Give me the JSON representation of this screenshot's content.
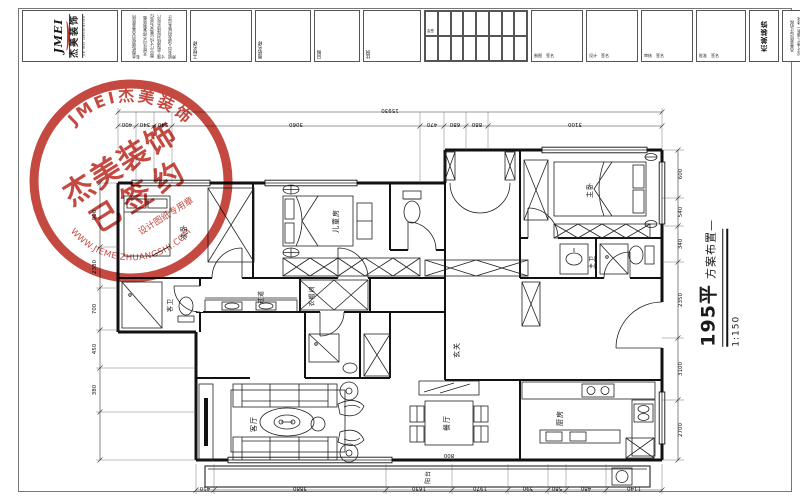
{
  "sheet": {
    "area_label": "195平",
    "plan_title": "方案布置—",
    "scale": "1:150"
  },
  "title_block": {
    "logo_jmei": "JMEI",
    "logo_cn": "杰美装饰",
    "logo_en": "JIE MEI Decoration",
    "notes": [
      "本图纸版权归杰美装饰所有",
      "未经许可不得复制转载",
      "图中尺寸均以毫米为单位",
      "施工前请核对现场实际尺寸",
      "如有出入请及时联系设计师"
    ],
    "project_label": "工程名称",
    "drawing_label": "图纸名称",
    "date_label": "日期",
    "scale_label": "比例",
    "sign_label": "会签",
    "staff": [
      {
        "label": "制图",
        "extra": "签名"
      },
      {
        "label": "设计",
        "extra": "签名"
      },
      {
        "label": "审核",
        "extra": "签名"
      },
      {
        "label": "批准",
        "extra": "签名"
      }
    ],
    "brand_cn": "杰美装饰",
    "brand_en": "JMEI Decoration",
    "contact": [
      "杰美装饰设计机构",
      "设计·施工·服务一体化",
      "WWW.JIEMEIZHUANGSHI.COM"
    ]
  },
  "stamp": {
    "arc_top": "JMEI杰美装饰",
    "line1": "杰美装饰",
    "line2": "已签约",
    "sub": "设计图纸专用章",
    "arc_bottom": "WWW.JIEMEIZHUANGSHI.COM",
    "color": "#bf3a30"
  },
  "rooms": {
    "bedroom2": "次卧",
    "kids": "儿童房",
    "master": "主卧",
    "master_bath": "主卫",
    "guest_bath": "客卫",
    "cloak": "衣帽间",
    "entry": "玄关",
    "corridor": "过道",
    "living": "客厅",
    "dining": "餐厅",
    "kitchen": "厨房",
    "balcony": "阳台"
  },
  "dims": {
    "top_total": "15930",
    "top": [
      "400",
      "340",
      "540",
      "3060",
      "470",
      "680",
      "880",
      "3100"
    ],
    "right": [
      "600",
      "540",
      "340",
      "2350",
      "3100",
      "2700"
    ],
    "bottom": [
      "410",
      "3880",
      "1630",
      "1970",
      "390",
      "580",
      "480",
      "1140"
    ],
    "left": [
      "900",
      "2380",
      "700",
      "450",
      "380"
    ],
    "dining_table": "800"
  }
}
